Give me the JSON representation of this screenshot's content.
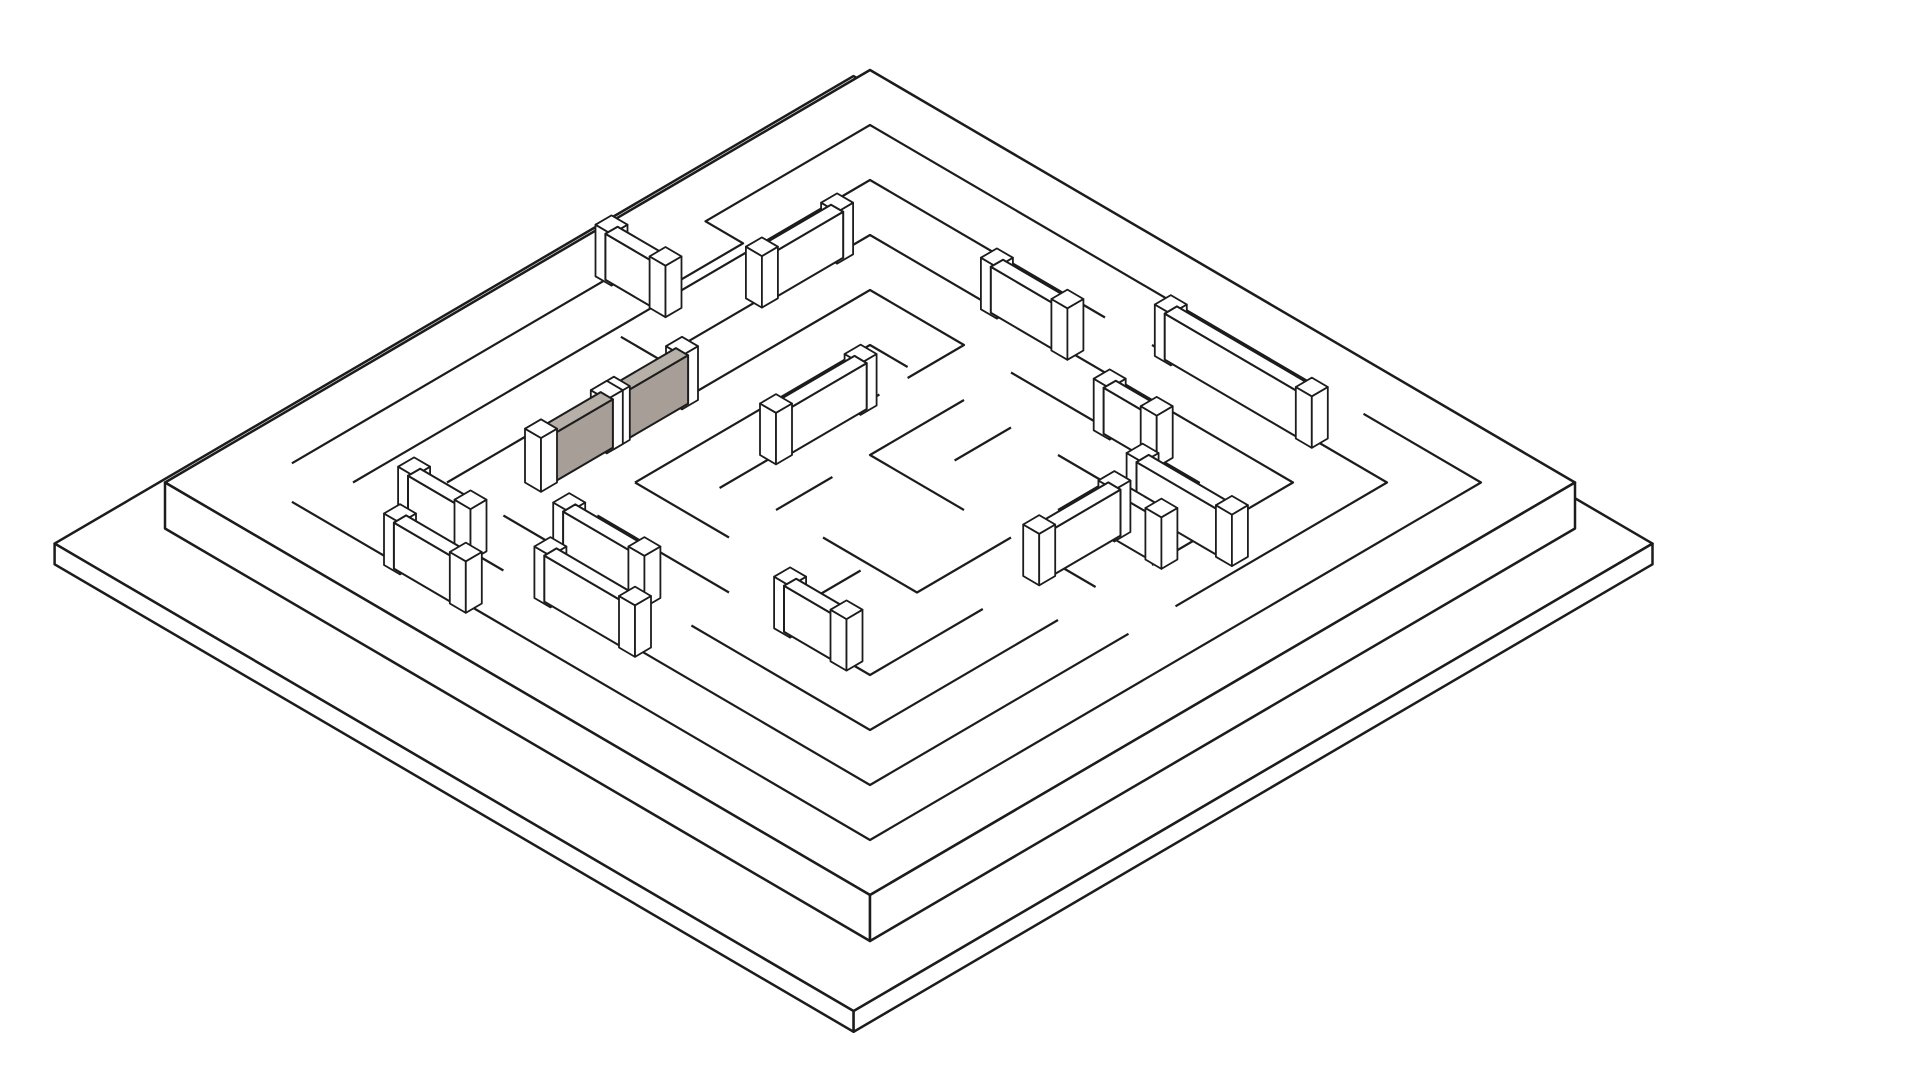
{
  "scene": {
    "kind": "isometric-maze-line-drawing",
    "colors": {
      "background": "#ffffff",
      "ink": "#1c1c1c",
      "surface": "#ffffff",
      "highlight_front": "#a79f97",
      "highlight_top": "#b6b0a8",
      "highlight_end": "#918a82"
    },
    "wall_height": 1.0,
    "post_extra_height": 0.12,
    "wall_half_thickness": 0.13,
    "post_half_size": 0.17
  },
  "plates": {
    "maze_plate": {
      "x": [
        -1,
        14
      ],
      "y": [
        -1,
        14
      ],
      "top_z": 0,
      "thickness": 1.0
    },
    "base_plate": {
      "x": [
        -1.9,
        15.1
      ],
      "y": [
        -1.55,
        15.45
      ],
      "top_z": -1.0,
      "thickness": 0.45
    }
  },
  "maze": {
    "grid": {
      "cols": 13,
      "rows": 13
    },
    "flat_walls": [
      [
        [
          0,
          12.3
        ],
        [
          0,
          5.5
        ],
        [
          0.8,
          5.5
        ],
        [
          0.8,
          3.5
        ],
        [
          0,
          3.5
        ],
        [
          0,
          0
        ],
        [
          9.5,
          0
        ]
      ],
      [
        [
          10.5,
          0
        ],
        [
          13,
          0
        ],
        [
          13,
          13
        ],
        [
          0.7,
          13
        ]
      ],
      [
        [
          1,
          12
        ],
        [
          1,
          1
        ],
        [
          6,
          1
        ]
      ],
      [
        [
          7,
          1
        ],
        [
          12,
          1
        ],
        [
          12,
          5.5
        ]
      ],
      [
        [
          12,
          6.5
        ],
        [
          12,
          12
        ],
        [
          5,
          12
        ]
      ],
      [
        [
          4.2,
          12
        ],
        [
          2.2,
          12
        ]
      ],
      [
        [
          2,
          11
        ],
        [
          2,
          2
        ],
        [
          4.5,
          2
        ]
      ],
      [
        [
          5.5,
          2
        ],
        [
          11,
          2
        ],
        [
          11,
          5
        ]
      ],
      [
        [
          11,
          7
        ],
        [
          11,
          11
        ],
        [
          7.2,
          11
        ]
      ],
      [
        [
          6.2,
          11
        ],
        [
          3.2,
          11
        ]
      ],
      [
        [
          3,
          6.8
        ],
        [
          3,
          3
        ],
        [
          5,
          3
        ],
        [
          5,
          4.2
        ]
      ],
      [
        [
          6,
          3
        ],
        [
          10,
          3
        ],
        [
          10,
          4.6
        ]
      ],
      [
        [
          10,
          7.6
        ],
        [
          10,
          10
        ],
        [
          8,
          10
        ]
      ],
      [
        [
          7,
          10
        ],
        [
          4.2,
          10
        ]
      ],
      [
        [
          4,
          9
        ],
        [
          4,
          4
        ],
        [
          4.8,
          4
        ]
      ],
      [
        [
          5,
          4.8
        ],
        [
          5,
          8.2
        ]
      ],
      [
        [
          4,
          9
        ],
        [
          6,
          9
        ]
      ],
      [
        [
          6,
          4
        ],
        [
          6,
          6
        ],
        [
          8,
          6
        ]
      ],
      [
        [
          7,
          4
        ],
        [
          7,
          5.2
        ]
      ],
      [
        [
          8,
          4
        ],
        [
          9,
          4
        ],
        [
          9,
          5
        ]
      ],
      [
        [
          9,
          6
        ],
        [
          9,
          8
        ],
        [
          7,
          8
        ]
      ],
      [
        [
          6,
          6.8
        ],
        [
          6,
          8
        ]
      ],
      [
        [
          8,
          8.2
        ],
        [
          8,
          9.2
        ]
      ],
      [
        [
          10,
          6
        ],
        [
          10.8,
          6
        ]
      ],
      [
        [
          1.2,
          6.5
        ],
        [
          2,
          6.5
        ]
      ]
    ],
    "raised_walls": [
      {
        "axis": "j",
        "at": 3,
        "from": 7.0,
        "to": 8.45,
        "highlight": true,
        "h": 1.05
      },
      {
        "axis": "j",
        "at": 3,
        "from": 8.6,
        "to": 10.0,
        "highlight": true,
        "h": 1.05
      },
      {
        "axis": "i",
        "at": 1,
        "from": 7.4,
        "to": 10.4,
        "highlight": false
      },
      {
        "axis": "i",
        "at": 2,
        "from": 4.7,
        "to": 6.2,
        "highlight": false
      },
      {
        "axis": "i",
        "at": 3,
        "from": 8.1,
        "to": 9.1,
        "highlight": false
      },
      {
        "axis": "i",
        "at": 4,
        "from": 9.8,
        "to": 11.7,
        "highlight": false
      },
      {
        "axis": "i",
        "at": 4.8,
        "from": 10.0,
        "to": 11.0,
        "highlight": false
      },
      {
        "axis": "j",
        "at": 5,
        "from": 5.2,
        "to": 7.0,
        "highlight": false
      },
      {
        "axis": "i",
        "at": 11,
        "from": 4.6,
        "to": 6.2,
        "highlight": false
      },
      {
        "axis": "i",
        "at": 12,
        "from": 5.2,
        "to": 7.0,
        "highlight": false
      },
      {
        "axis": "i",
        "at": 5.5,
        "from": 0.0,
        "to": 1.15,
        "highlight": false
      },
      {
        "axis": "i",
        "at": 13,
        "from": 3.0,
        "to": 4.4,
        "highlight": false
      },
      {
        "axis": "i",
        "at": 12,
        "from": 2.3,
        "to": 3.5,
        "highlight": false
      },
      {
        "axis": "i",
        "at": 10,
        "from": 8.3,
        "to": 9.5,
        "highlight": false
      },
      {
        "axis": "j",
        "at": 2,
        "from": 2.7,
        "to": 4.3,
        "highlight": false
      },
      {
        "axis": "j",
        "at": 10,
        "from": 4.8,
        "to": 6.4,
        "highlight": false
      }
    ]
  }
}
